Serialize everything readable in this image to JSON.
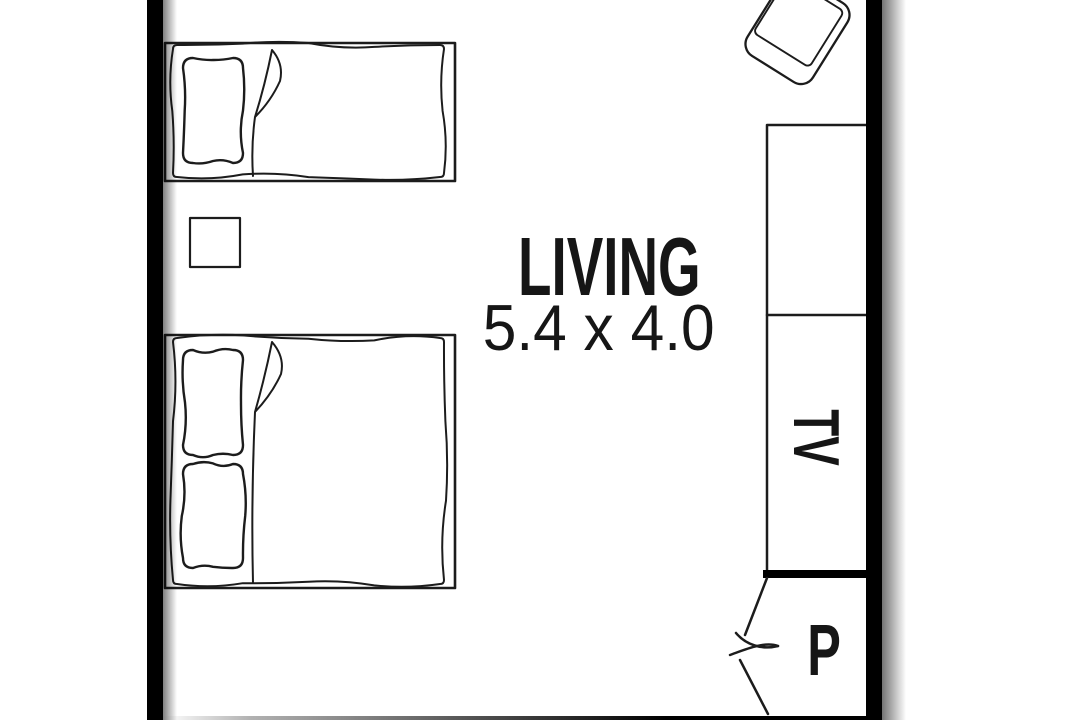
{
  "floorplan": {
    "room_label": "LIVING",
    "room_dimensions": "5.4 x 4.0",
    "tv_label": "TV",
    "pantry_label": "P",
    "colors": {
      "wall": "#000000",
      "line": "#1c1c1c",
      "text": "#161616",
      "background": "#ffffff"
    },
    "furniture": [
      "single-bed",
      "double-bed",
      "bedside-table",
      "armchair",
      "wall-cabinet",
      "tv-unit",
      "pantry"
    ]
  }
}
